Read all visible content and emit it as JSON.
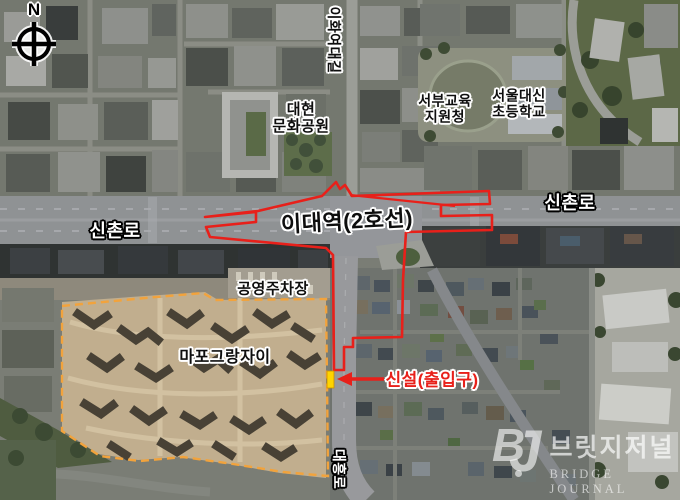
{
  "colors": {
    "station_outline": "#e8201a",
    "annotation_red": "#e8201a",
    "site_boundary": "#f2a33c",
    "marker_yellow": "#ffd400"
  },
  "compass": {
    "north_label": "N"
  },
  "labels": {
    "ewha_univ_road": "이화여대길",
    "daehyun_culture_park": "대현\n문화공원",
    "western_education_office": "서부교육\n지원청",
    "seoul_daesin_elementary": "서울대신\n초등학교",
    "sinchon_ro_west": "신촌로",
    "sinchon_ro_east": "신촌로",
    "ewha_station_line2": "이대역(2호선)",
    "public_parking_lot": "공영주차장",
    "mapo_grand_xi": "마포그랑자이",
    "new_entrance_note": "신설(출입구)",
    "daeheung_ro": "대흥로"
  },
  "watermark": {
    "logo_b": "B",
    "logo_j": "J",
    "name_korean": "브릿지저널",
    "name_english": "BRIDGE JOURNAL"
  }
}
